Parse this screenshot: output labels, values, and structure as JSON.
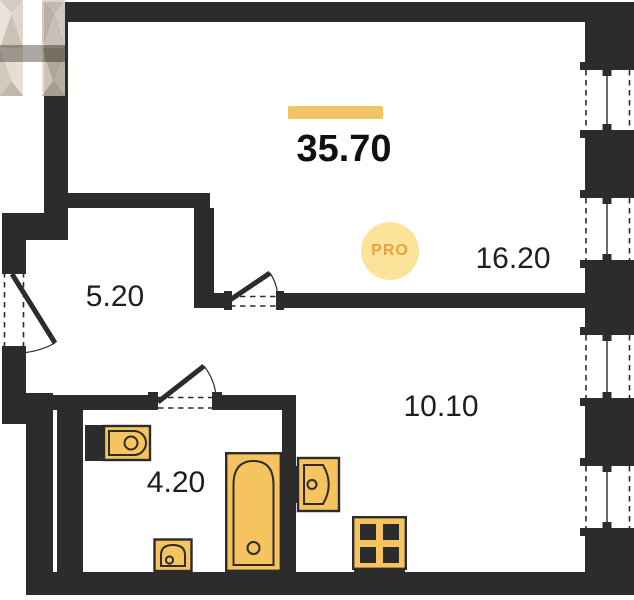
{
  "plan": {
    "total_area": "35.70",
    "rooms": [
      {
        "name": "room",
        "area": "16.20"
      },
      {
        "name": "hallway",
        "area": "5.20"
      },
      {
        "name": "kitchen-living-room",
        "area": "10.10"
      },
      {
        "name": "bathroom",
        "area": "4.20"
      }
    ],
    "watermark": {
      "badge": "PRO",
      "logo": "h-monogram"
    },
    "fixtures": [
      "toilet",
      "washbasin",
      "bathtub",
      "kitchen-sink",
      "stove"
    ],
    "features": {
      "windows": 4,
      "doors": 3
    },
    "colors": {
      "wall": "#2c2c2c",
      "fixture_fill": "#f6c45f",
      "accent_bar": "#f3c463",
      "badge_bg": "#fbe49a",
      "badge_text": "#e8a23b",
      "background": "#ffffff"
    }
  }
}
